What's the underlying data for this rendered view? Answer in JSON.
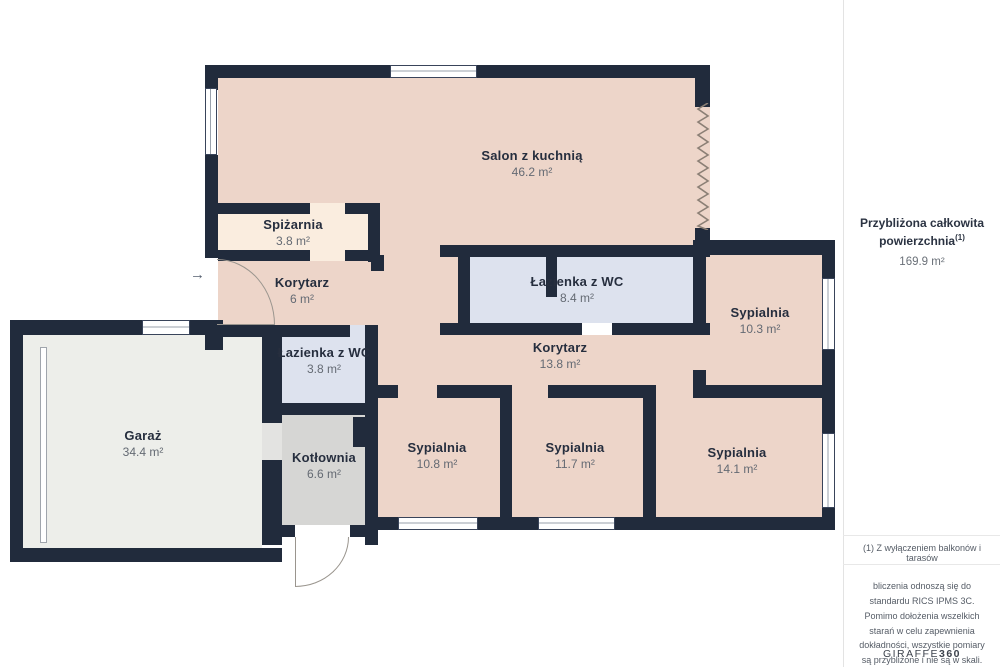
{
  "palette": {
    "wall": "#212B3C",
    "floor_main": "#EDD5C9",
    "floor_pantry": "#FAEDDF",
    "floor_bathroom": "#DDE2EE",
    "floor_boiler_room": "#D6D6D4",
    "floor_garage": "#EDEEEA"
  },
  "plan": {
    "entry_arrow": "→"
  },
  "rooms": [
    {
      "name": "Salon z kuchnią",
      "area": "46.2 m²"
    },
    {
      "name": "Spiżarnia",
      "area": "3.8 m²"
    },
    {
      "name": "Korytarz",
      "area": "6 m²"
    },
    {
      "name": "Łazienka z WC",
      "area": "8.4 m²"
    },
    {
      "name": "Sypialnia",
      "area": "10.3 m²"
    },
    {
      "name": "Korytarz",
      "area": "13.8 m²"
    },
    {
      "name": "Łazienka z WC",
      "area": "3.8 m²"
    },
    {
      "name": "Garaż",
      "area": "34.4 m²"
    },
    {
      "name": "Kotłownia",
      "area": "6.6 m²"
    },
    {
      "name": "Sypialnia",
      "area": "10.8 m²"
    },
    {
      "name": "Sypialnia",
      "area": "11.7 m²"
    },
    {
      "name": "Sypialnia",
      "area": "14.1 m²"
    }
  ],
  "sidebar": {
    "summary_title": "Przybliżona całkowita powierzchnia",
    "summary_sup": "(1)",
    "summary_value": "169.9 m²",
    "footnote": "(1) Z wyłączeniem balkonów i tarasów",
    "disclaimer": "bliczenia odnoszą się do standardu RICS IPMS 3C. Pomimo dołożenia wszelkich starań w celu zapewnienia dokładności, wszystkie pomiary są przybliżone i nie są w skali. Ten plan piętra ma charakter poglądowy.",
    "brand_name": "GIRAFFE",
    "brand_suffix": "360"
  }
}
